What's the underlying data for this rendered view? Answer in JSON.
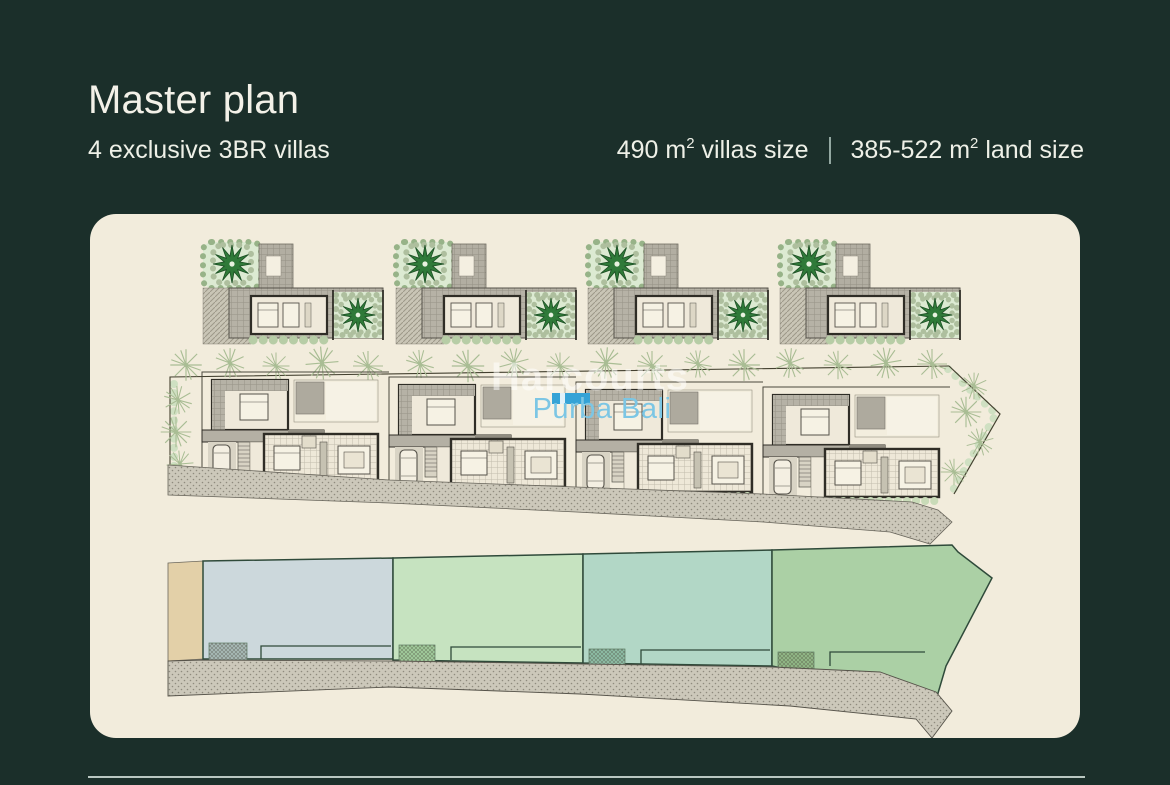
{
  "header": {
    "title": "Master plan",
    "subtitle": "4 exclusive 3BR villas",
    "stats": {
      "villas_size": {
        "value": "490 m",
        "sup": "2",
        "label": " villas size"
      },
      "land_size": {
        "value": "385-522 m",
        "sup": "2",
        "label": " land size"
      }
    }
  },
  "watermark": {
    "brand": "Harcourts",
    "office": "Purba Bali"
  },
  "plan": {
    "colors": {
      "background": "#1b2f2a",
      "panel": "#f2ecdc",
      "sand": "#e3d0a8",
      "lot1": "#ccd8dc",
      "lot2": "#c6e3c0",
      "lot3": "#b2d7c6",
      "lot4": "#abd0a5",
      "road": "#ccc8ba",
      "tree": "#2f7a39",
      "logo_blue": "#35a3d6",
      "watermark_blue": "#7cc6e4"
    }
  }
}
